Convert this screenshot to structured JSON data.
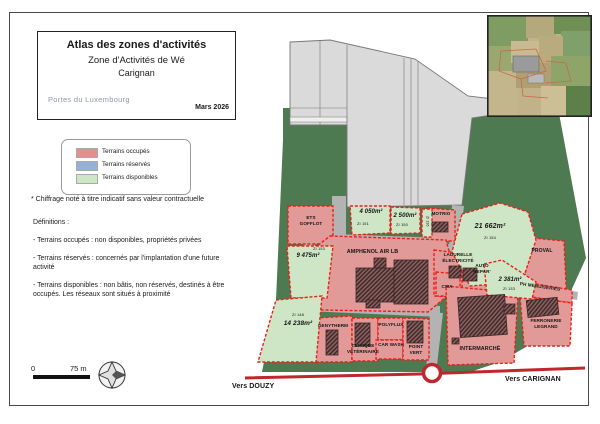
{
  "title_block": {
    "title": "Atlas des zones d'activités",
    "subtitle": "Zone d'Activités de Wé",
    "city": "Carignan",
    "logo_text": "Portes du Luxembourg",
    "date": "Mars 2026"
  },
  "legend": {
    "items": [
      {
        "label": "Terrains occupés",
        "color": "#e28f8d"
      },
      {
        "label": "Terrains réservés",
        "color": "#94b1d8"
      },
      {
        "label": "Terrains disponibles",
        "color": "#cfe6c6"
      }
    ]
  },
  "footnote": "* Chiffrage noté à titre indicatif sans valeur contractuelle",
  "definitions": {
    "heading": "Définitions :",
    "items": [
      "- Terrains occupés : non disponibles, propriétés privées",
      "- Terrains réservés : concernés par l'implantation d'une future activité",
      "- Terrains disponibles : non bâtis, non réservés, destinés à être occupés. Les réseaux sont situés à proximité"
    ]
  },
  "scale": {
    "zero": "0",
    "distance": "75 m"
  },
  "map": {
    "colors": {
      "occupied_fill": "#e29a98",
      "available_fill": "#cfe6c6",
      "parcel_border": "#ea1f18",
      "vegetation": "#4e7a52",
      "fields": "#dadada",
      "road_red": "#c0272d"
    },
    "occupied": {
      "ets_gofflot": "ETS GOFFLOT",
      "motrio": "MOTRIO",
      "amphenol": "AMPHENOL AIR LB",
      "proval": "PROVAL",
      "ladurelle": "LADURELLE ÉLECTRICITÉ",
      "cwa": "CWA",
      "auto_repar": "AUTO REPAR'",
      "ph_menuiseries": "PH MENUISERIES",
      "ferronerie": "FERRONERIE LEGRAND",
      "intermarche": "INTERMARCHÉ",
      "genytherm": "GENYTHERM",
      "clinique": "CLINIQUE VÉTÉRINAIRE",
      "polyflux": "POLYFLUX",
      "car_wash": "CAR WASH",
      "point_vert": "POINT VERT"
    },
    "available": {
      "zi151": {
        "area": "4 050m²",
        "ref": "ZI 151"
      },
      "zi150": {
        "area": "2 500m²",
        "ref": "ZI 150"
      },
      "zi136": {
        "ref": "ZI 136"
      },
      "zi154": {
        "area": "21 662m²",
        "ref": "ZI 154"
      },
      "zi153": {
        "area": "9 475m²",
        "ref": "ZI 153"
      },
      "zi133": {
        "area": "2 381m²",
        "ref": "ZI 133"
      },
      "zi148": {
        "area": "14 238m²",
        "ref": "ZI 148"
      }
    },
    "directions": {
      "left": "Vers DOUZY",
      "right": "Vers CARIGNAN"
    }
  }
}
